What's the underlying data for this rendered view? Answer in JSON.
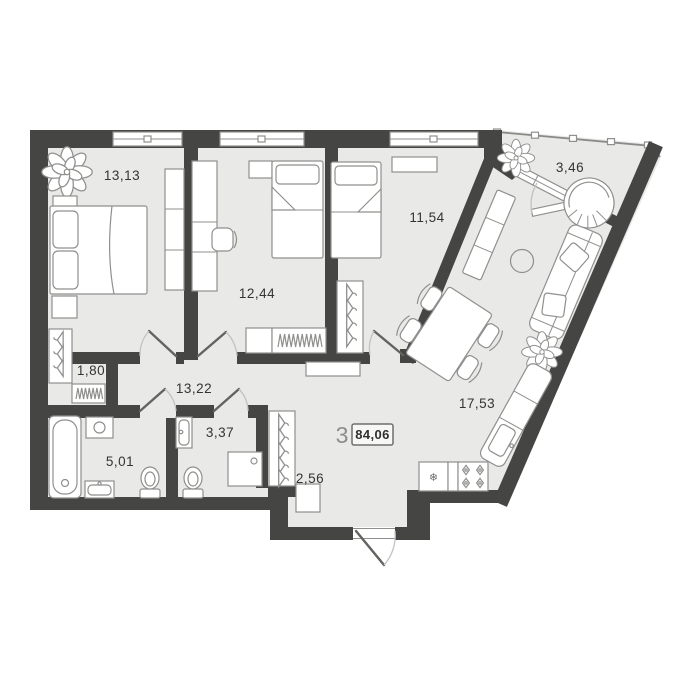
{
  "plan": {
    "summary": {
      "rooms_count": "3",
      "total_area": "84,06"
    },
    "rooms": [
      {
        "name": "bedroom-1",
        "area": "13,13"
      },
      {
        "name": "bedroom-2",
        "area": "12,44"
      },
      {
        "name": "bedroom-3",
        "area": "11,54"
      },
      {
        "name": "kitchen-living",
        "area": "17,53"
      },
      {
        "name": "hallway",
        "area": "13,22"
      },
      {
        "name": "bathroom",
        "area": "5,01"
      },
      {
        "name": "wc",
        "area": "3,37"
      },
      {
        "name": "closet",
        "area": "2,56"
      },
      {
        "name": "wardrobe-niche",
        "area": "1,80"
      },
      {
        "name": "balcony",
        "area": "3,46"
      }
    ],
    "icons": {
      "fridge": "❄"
    },
    "colors": {
      "wall": "#454544",
      "floor": "#e9e9e7",
      "furniture_stroke": "#8f908e",
      "label_text": "#343432",
      "muted_text": "#8d8d8b"
    }
  }
}
